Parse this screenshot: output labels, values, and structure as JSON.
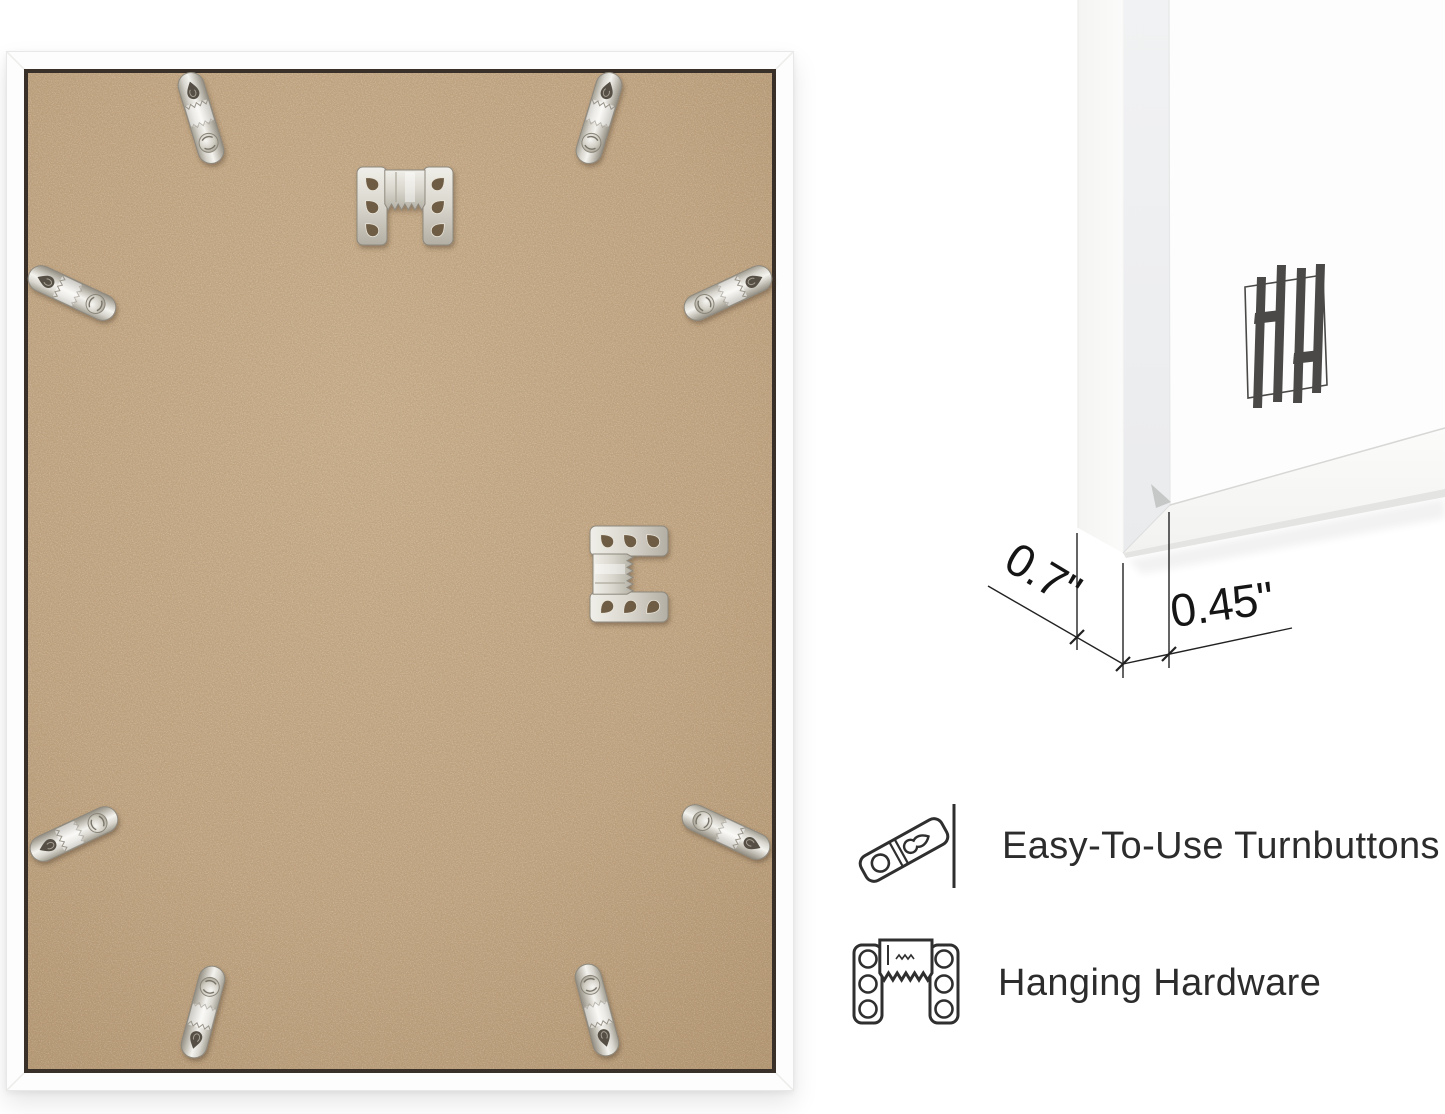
{
  "product_visual": {
    "frame_color": "#fdfdfd",
    "board_color": "#c3a683",
    "metal_color": "#d7d5cd",
    "turnbutton_count": 8,
    "sawtooth_hanger_count": 2,
    "brand_logo": "hh-monogram"
  },
  "dimension_callout": {
    "depth_label": "0.7\"",
    "width_label": "0.45\""
  },
  "features": [
    {
      "icon": "turnbutton-icon",
      "label": "Easy-To-Use Turnbuttons"
    },
    {
      "icon": "hanging-hardware-icon",
      "label": "Hanging Hardware"
    }
  ]
}
